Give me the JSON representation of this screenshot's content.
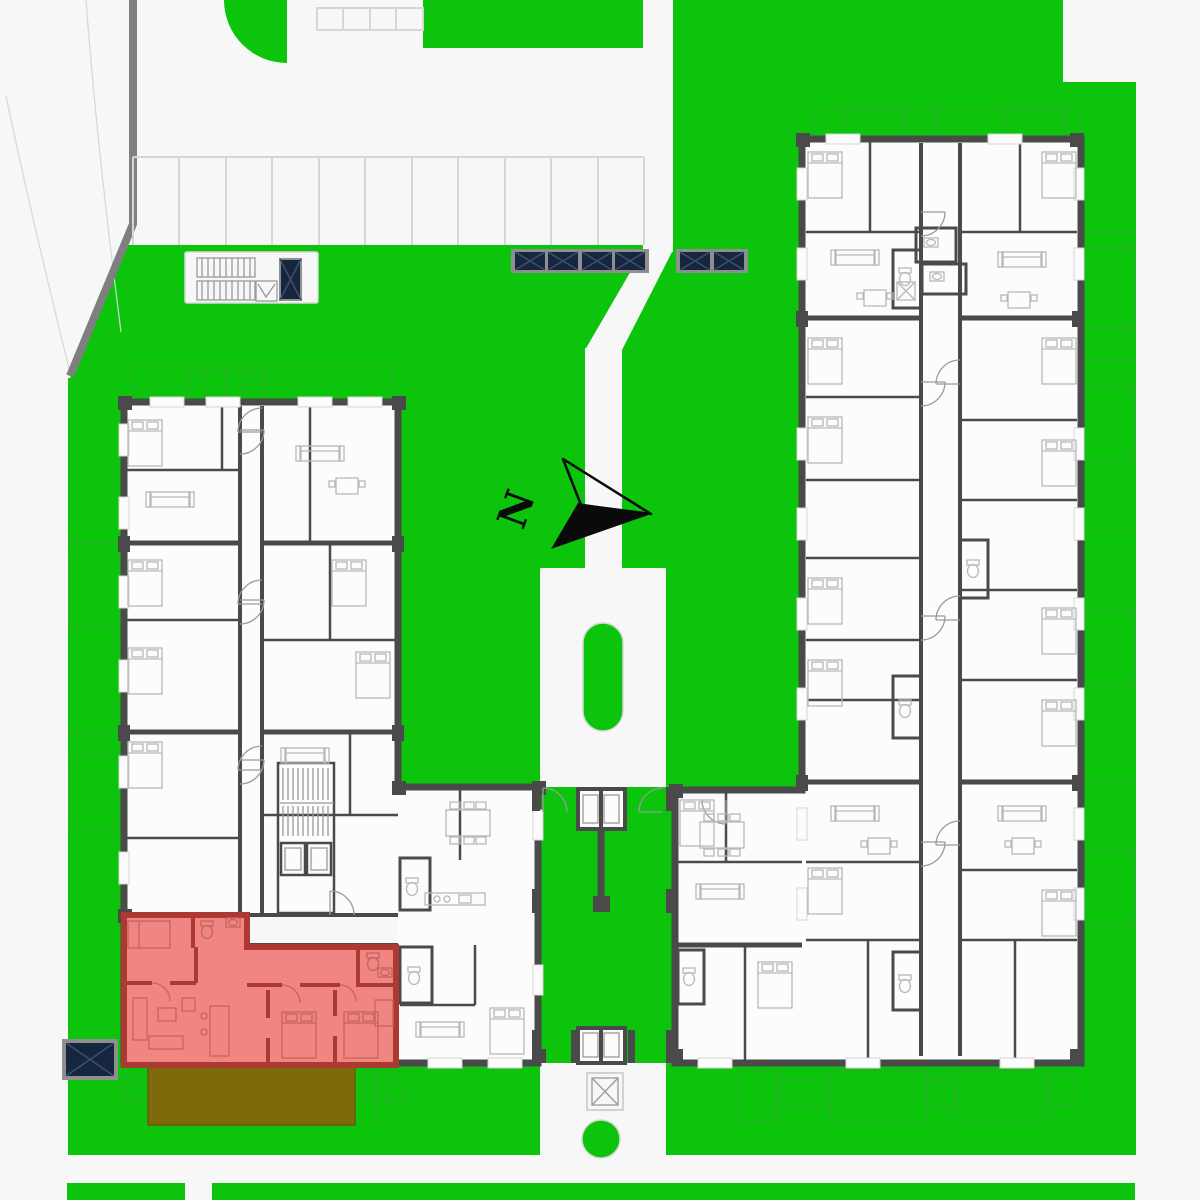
{
  "compass": {
    "label": "N"
  },
  "highlighted_unit": {
    "fill": "#F18581",
    "wall": "#AC3A32",
    "terrace_fill": "#7D6B0B"
  },
  "panels": {
    "center_strip_cells": 4,
    "right_strip_cells": 2,
    "southwest_box_cells": 1,
    "stairwell_box_cells": 1
  },
  "colors": {
    "lawn": "#0BC40B",
    "pavement": "#F7F7F7",
    "pavement_line": "#D6D6D6",
    "curb": "#7F7F7F",
    "wall": "#4A4A4A",
    "building_fill": "#FCFCFC",
    "plan_line": "#9A9A9A",
    "furniture_line": "#B8B8B8",
    "highlight_unit_fill": "#F18581",
    "highlight_unit_wall": "#AC3A32",
    "highlight_unit_line": "#C4655F",
    "terrace_olive": "#7D6B0B",
    "terrace_olive_line": "#6A5A09",
    "panel_navy": "#16263E",
    "panel_x_line": "#3D4E6B",
    "panel_frame": "#8F8F8F",
    "terrace_outline": "#3F9F3F",
    "ink": "#0A0A0A"
  }
}
